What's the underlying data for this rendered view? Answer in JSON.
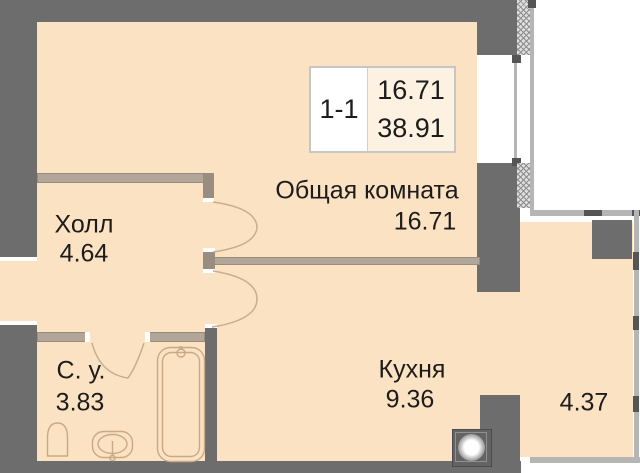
{
  "title_block": {
    "unit": "1-1",
    "living_area": "16.71",
    "total_area": "38.91"
  },
  "rooms": {
    "hall": {
      "name": "Холл",
      "area": "4.64"
    },
    "living": {
      "name": "Общая комната",
      "area": "16.71"
    },
    "bathroom": {
      "name": "С. у.",
      "area": "3.83"
    },
    "kitchen": {
      "name": "Кухня",
      "area": "9.36"
    },
    "loggia": {
      "area": "4.37"
    }
  },
  "colors": {
    "wall": "#6d6d6d",
    "floor": "#fbe2c3",
    "innerwall": "#b2a698",
    "line": "#b5b5b5",
    "text": "#1c1c1c",
    "door": "#c5ad8d",
    "fixture": "#c9a983",
    "titlefill": "#fdf1e1"
  }
}
